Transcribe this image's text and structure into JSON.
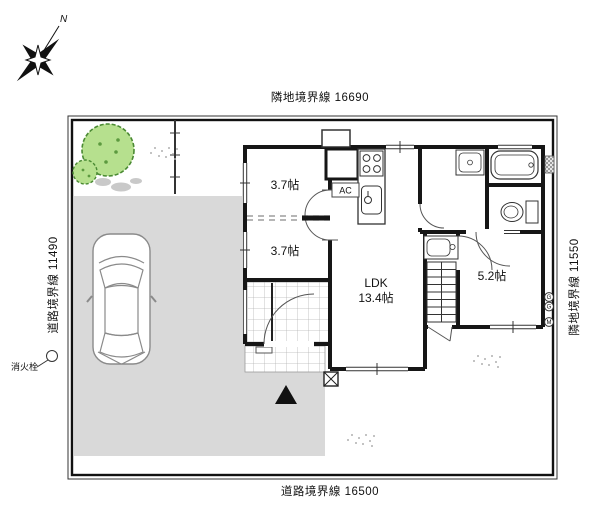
{
  "plan": {
    "dimensions": {
      "top": "隣地境界線 16690",
      "bottom": "道路境界線 16500",
      "left": "道路境界線 11490",
      "right": "隣地境界線 11550"
    },
    "compass": {
      "north": "N"
    },
    "labels": {
      "fire_hydrant": "消火栓",
      "ac": "AC"
    },
    "rooms": {
      "room_west_upper": "3.7帖",
      "room_west_lower": "3.7帖",
      "ldk_name": "LDK",
      "ldk_area": "13.4帖",
      "room_east": "5.2帖"
    },
    "meters": {
      "top": "G",
      "middle": "G",
      "bottom": "M"
    },
    "colors": {
      "wall": "#161616",
      "driveway": "#d9d9d9",
      "tree_fill": "#b6e08e",
      "tree_stroke": "#4a8a33"
    }
  }
}
